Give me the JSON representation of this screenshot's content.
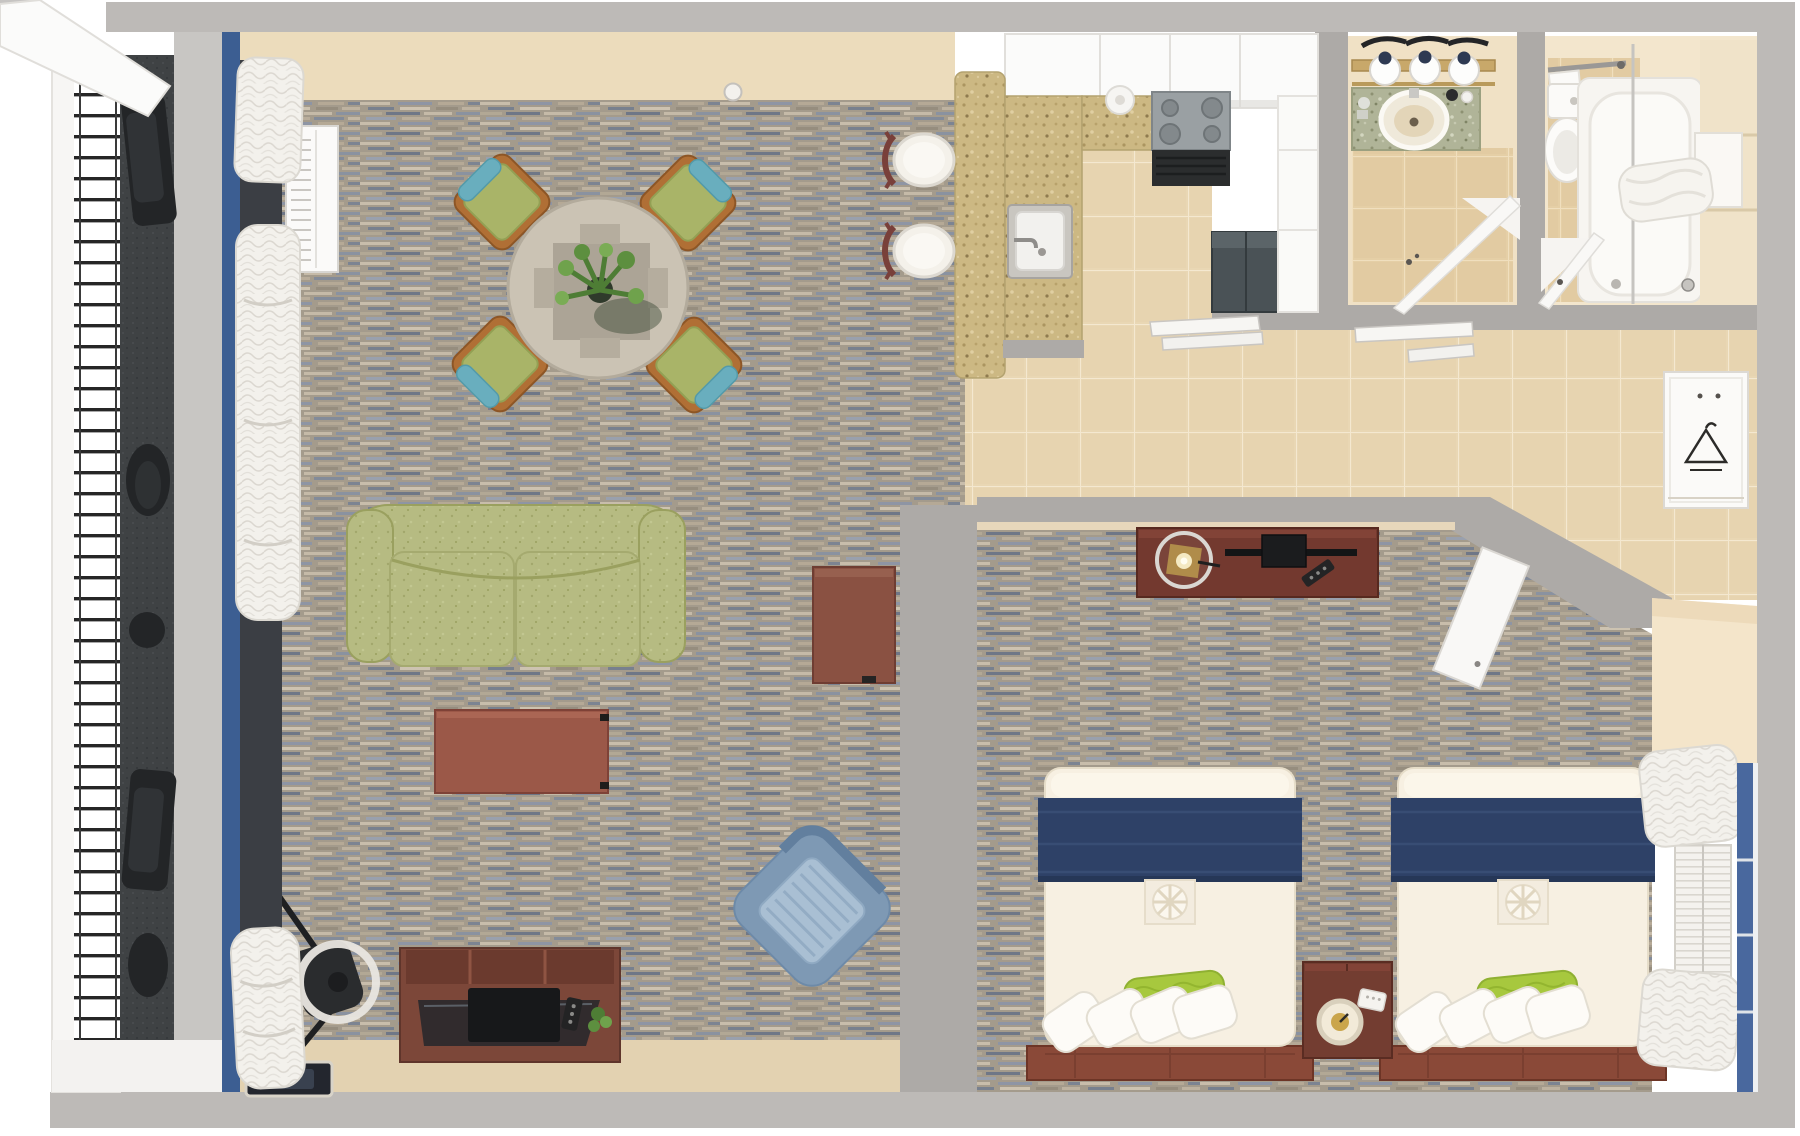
{
  "scene": {
    "title": "Top-down 3D floor plan render of a hotel suite",
    "type": "architectural-floorplan-render",
    "visible_text": "none"
  },
  "palette": {
    "outer_bg": "#ffffff",
    "wall_outer": "#bdbab7",
    "wall_inner": "#adaaa7",
    "cream_floor": "#ecdcbc",
    "cream_floor_dark": "#e3d2b1",
    "carpet_base": "#a49b8c",
    "carpet_blue": "#8e95a4",
    "tile_floor": "#e9d7b4",
    "bath_floor": "#e5cfa6",
    "counter_speckle": "#ccb883",
    "granite": "#b0b498",
    "cabinet_white": "#fbfbfa",
    "sofa_green": "#b6bb82",
    "chair_green": "#a9b468",
    "accent_teal": "#69aebe",
    "wood_orange": "#b06f35",
    "wood_red": "#9b5848",
    "wood_dark": "#7c4739",
    "navy": "#2e4167",
    "duvet_white": "#f7f0e2",
    "pillow_green": "#a7c83e",
    "armchair_blue": "#7e99b4",
    "armchair_cushion": "#a9bfd3",
    "balcony_dark": "#3f4244",
    "blue_wall": "#3c5e92",
    "blue_window": "#49689e",
    "door_white": "#f9f8f6",
    "appliance_dark": "#4a5256",
    "stove_gray": "#9aa0a3"
  },
  "rooms": {
    "living": {
      "label": "living and dining room",
      "furniture": [
        "round dining table with plant centerpiece",
        "4 green dining chairs with teal pillows",
        "green sofa",
        "coffee table",
        "side table",
        "blue armchair",
        "media console with TV, remote and plant",
        "desk chair",
        "floor mat",
        "PTAC air conditioner",
        "ceiling detector",
        "white curtains"
      ]
    },
    "kitchen": {
      "label": "kitchenette",
      "furniture": [
        "L-shaped speckled counter",
        "sink with faucet",
        "2 bar stools",
        "upper cabinets",
        "range with 4 burners",
        "refrigerator",
        "white cabinet column",
        "paper towel roll"
      ]
    },
    "bath1": {
      "label": "vanity bathroom",
      "furniture": [
        "vanity light bar with 3 lamps",
        "granite vanity with oval sink",
        "toiletries",
        "open door"
      ]
    },
    "bath2": {
      "label": "tub bathroom",
      "furniture": [
        "toilet",
        "towel bar with towel",
        "bathtub with shower curtain",
        "shelf niche",
        "open door"
      ]
    },
    "bedroom": {
      "label": "bedroom",
      "furniture": [
        "TV dresser with lamp, flat TV and remote",
        "two beds with navy runners, green pillows and white pillows",
        "wood foot benches",
        "nightstand with alarm clock and phone",
        "window with roman shades",
        "entry door"
      ]
    },
    "hall": {
      "label": "hallway",
      "furniture": [
        "tile floor",
        "wall shelves",
        "closet with hanger"
      ]
    },
    "balcony": {
      "label": "balcony",
      "furniture": [
        "railing window",
        "dark outdoor furniture"
      ]
    }
  }
}
